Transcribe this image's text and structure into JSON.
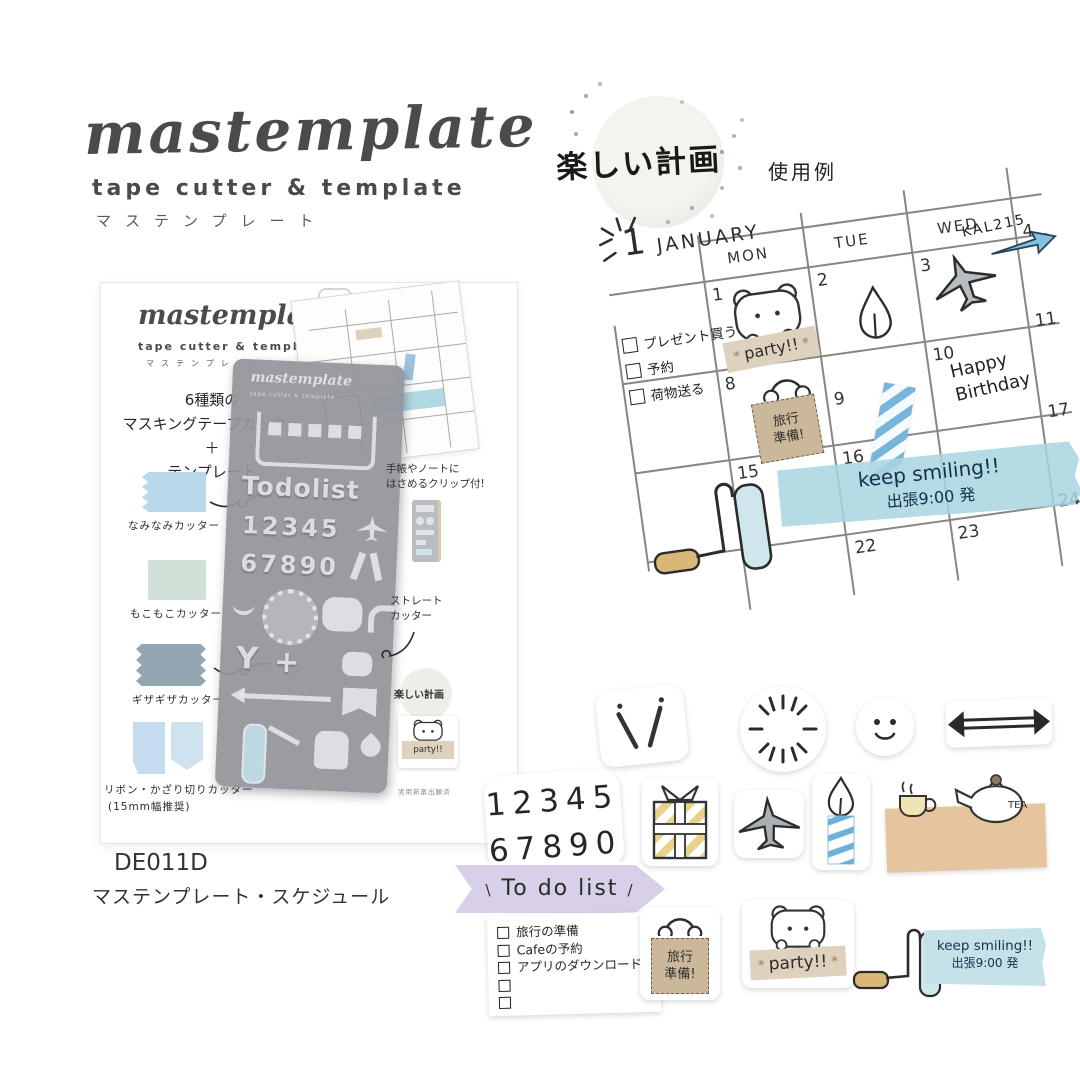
{
  "logo": {
    "brand": "mastemplate",
    "subtitle": "tape cutter & template",
    "katakana": "マステンプレート"
  },
  "stamp": {
    "text": "楽しい計画"
  },
  "usage_label": "使用例",
  "calendar": {
    "month_number": "1",
    "month_name": "JANUARY",
    "day_headers": [
      "MON",
      "TUE",
      "WED"
    ],
    "checklist": [
      "プレゼント買う",
      "予約",
      "荷物送る"
    ],
    "dates": {
      "d1": "1",
      "d2": "2",
      "d3": "3",
      "d4": "4",
      "d8": "8",
      "d9": "9",
      "d10": "10",
      "d11": "11",
      "d15": "15",
      "d16": "16",
      "d17": "17",
      "d22": "22",
      "d23": "23",
      "d24": "24"
    },
    "flight_label": "KAL215",
    "party_label": "party!!",
    "birthday_line1": "Happy",
    "birthday_line2": "Birthday",
    "bag_line1": "旅行",
    "bag_line2": "準備!",
    "washi_line1": "keep smiling!!",
    "washi_line2": "出張9:00 発"
  },
  "package": {
    "brand": "mastemplate",
    "subtitle": "tape cutter & template",
    "katakana": "マステンプレート",
    "feature_line1": "6種類の",
    "feature_line2": "マスキングテープカッター",
    "feature_plus": "＋",
    "feature_line3": "テンプレート",
    "sample_labels": [
      "なみなみカッター",
      "もこもこカッター",
      "ギザギザカッター",
      "リボン・かざり切りカッター",
      "(15mm幅推奨)"
    ],
    "clip_note_line1": "手帳やノートに",
    "clip_note_line2": "はさめるクリップ付!",
    "straight_line1": "ストレート",
    "straight_line2": "カッター",
    "stamp_text": "楽しい計画",
    "party_label": "party!!",
    "patent_note": "実用新案出願済",
    "stencil": {
      "brand": "mastemplate",
      "subtitle": "tape cutter & template",
      "todolist": "Todolist",
      "numbers_row1": "12345",
      "numbers_row2": "67890"
    }
  },
  "product": {
    "code": "DE011D",
    "name": "マステンプレート・スケジュール"
  },
  "stickers": {
    "numbers_row1": "12345",
    "numbers_row2": "67890",
    "banner_label": "To do list",
    "todo_items": [
      "旅行の準備",
      "Cafeの予約",
      "アプリのダウンロード"
    ],
    "bag_line1": "旅行",
    "bag_line2": "準備!",
    "party_label": "party!!",
    "tea_label": "TEA",
    "washi_line1": "keep smiling!!",
    "washi_line2": "出張9:00 発"
  }
}
